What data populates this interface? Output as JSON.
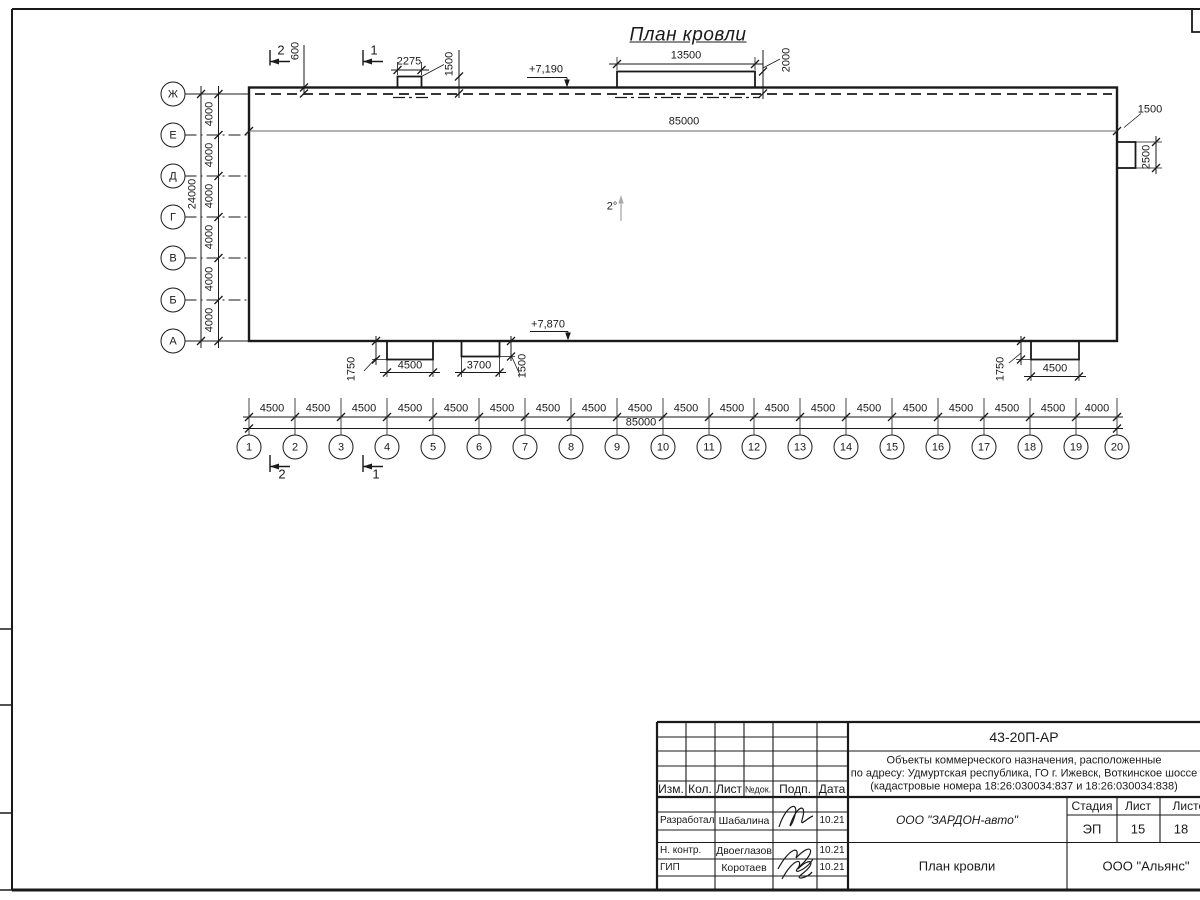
{
  "sheet": {
    "title": "План кровли"
  },
  "axes": {
    "letters": [
      "Ж",
      "Е",
      "Д",
      "Г",
      "В",
      "Б",
      "А"
    ],
    "numbers": [
      "1",
      "2",
      "3",
      "4",
      "5",
      "6",
      "7",
      "8",
      "9",
      "10",
      "11",
      "12",
      "13",
      "14",
      "15",
      "16",
      "17",
      "18",
      "19",
      "20"
    ],
    "letter_spacings": [
      "4000",
      "4000",
      "4000",
      "4000",
      "4000",
      "4000"
    ],
    "letter_total": "24000",
    "number_spacings": [
      "4500",
      "4500",
      "4500",
      "4500",
      "4500",
      "4500",
      "4500",
      "4500",
      "4500",
      "4500",
      "4500",
      "4500",
      "4500",
      "4500",
      "4500",
      "4500",
      "4500",
      "4500",
      "4000"
    ],
    "number_total": "85000"
  },
  "dims": {
    "ridge_length": "85000",
    "overhang": "600",
    "vent1_width": "2275",
    "vent1_height": "1500",
    "vent2_width": "13500",
    "vent2_height": "2000",
    "right_box_width": "1500",
    "right_box_height": "2500",
    "canopy1_width": "4500",
    "canopy1_height": "1750",
    "canopy2_width": "3700",
    "canopy2_height": "1500",
    "canopy3_width": "4500",
    "canopy3_height": "1750",
    "elev_top": "+7,190",
    "elev_bottom": "+7,870",
    "slope": "2°"
  },
  "sections": {
    "one": "1",
    "two": "2"
  },
  "titleblock": {
    "doc_code": "43-20П-АР",
    "address_line1": "Объекты коммерческого назначения, расположенные",
    "address_line2": "по адресу: Удмуртская республика, ГО г. Ижевск, Воткинское шоссе",
    "address_line3": "(кадастровые номера 18:26:030034:837 и 18:26:030034:838)",
    "header": {
      "izm": "Изм.",
      "kol": "Кол.",
      "list": "Лист",
      "ndok": "№док.",
      "podp": "Подп.",
      "data": "Дата"
    },
    "rows": [
      {
        "role": "Разработал",
        "name": "Шабалина",
        "date": "10.21"
      },
      {
        "role": "Н. контр.",
        "name": "Двоеглазов",
        "date": "10.21"
      },
      {
        "role": "ГИП",
        "name": "Коротаев",
        "date": "10.21"
      }
    ],
    "company": "ООО \"ЗАРДОН-авто\"",
    "sheet_title": "План кровли",
    "stage_label": "Стадия",
    "sheet_label": "Лист",
    "sheets_label": "Листов",
    "stage": "ЭП",
    "sheet_no": "15",
    "sheets_total": "18",
    "contractor": "ООО \"Альянс\""
  }
}
